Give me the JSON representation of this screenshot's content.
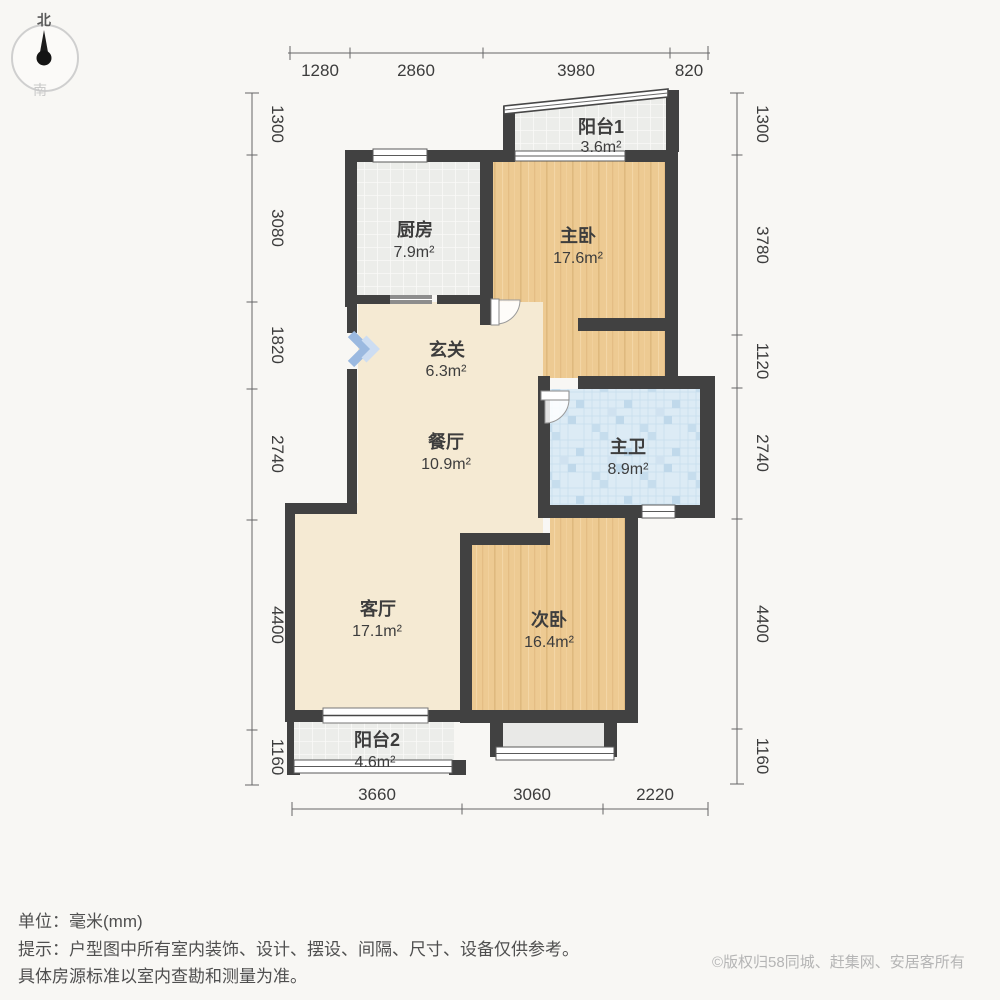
{
  "compass": {
    "north": "北",
    "south": "南"
  },
  "rooms": [
    {
      "id": "balcony1",
      "name": "阳台1",
      "area": "3.6m²"
    },
    {
      "id": "kitchen",
      "name": "厨房",
      "area": "7.9m²"
    },
    {
      "id": "master-bedroom",
      "name": "主卧",
      "area": "17.6m²"
    },
    {
      "id": "entry",
      "name": "玄关",
      "area": "6.3m²"
    },
    {
      "id": "dining",
      "name": "餐厅",
      "area": "10.9m²"
    },
    {
      "id": "master-bath",
      "name": "主卫",
      "area": "8.9m²"
    },
    {
      "id": "living",
      "name": "客厅",
      "area": "17.1m²"
    },
    {
      "id": "second-bedroom",
      "name": "次卧",
      "area": "16.4m²"
    },
    {
      "id": "balcony2",
      "name": "阳台2",
      "area": "4.6m²"
    }
  ],
  "dimensions": {
    "top": [
      "1280",
      "2860",
      "3980",
      "820"
    ],
    "left": [
      "1300",
      "3080",
      "1820",
      "2740",
      "4400",
      "1160"
    ],
    "right": [
      "1300",
      "3780",
      "1120",
      "2740",
      "4400",
      "1160"
    ],
    "bottom": [
      "3660",
      "3060",
      "2220"
    ]
  },
  "footer": {
    "unit": "单位：毫米(mm)",
    "tip": "提示：户型图中所有室内装饰、设计、摆设、间隔、尺寸、设备仅供参考。",
    "tip2": "具体房源标准以室内查勘和测量为准。",
    "copyright": "©版权归58同城、赶集网、安居客所有"
  },
  "colors": {
    "wall": "#414141",
    "wood_floor": "#edca92",
    "cream_floor": "#f5ead3",
    "tile_floor": "#ecedea",
    "bath_tile": "#dcebf5",
    "entry_arrow": "#9bb9e0",
    "dim_text": "#3c3c3c",
    "copyright_gray": "#b5b5b5"
  }
}
